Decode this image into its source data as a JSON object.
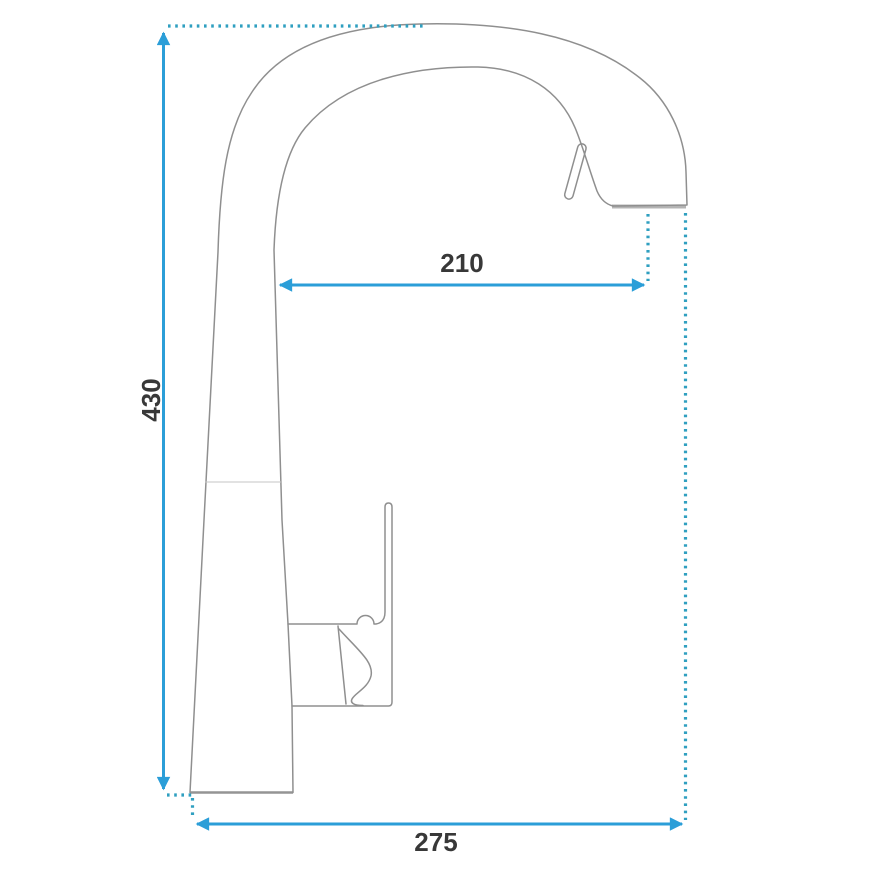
{
  "diagram": {
    "type": "technical-dimension-drawing",
    "subject": "kitchen-faucet-side-profile",
    "dimensions": {
      "height": {
        "label": "430",
        "orientation": "vertical"
      },
      "spout_reach": {
        "label": "210",
        "orientation": "horizontal"
      },
      "base_width": {
        "label": "275",
        "orientation": "horizontal"
      }
    },
    "colors": {
      "dimension_arrow_blue": "#2b9ed8",
      "extension_dot_teal": "#2f9fc0",
      "outline_gray": "#8f8f8f",
      "label_dark": "#383838",
      "background": "#ffffff"
    }
  }
}
